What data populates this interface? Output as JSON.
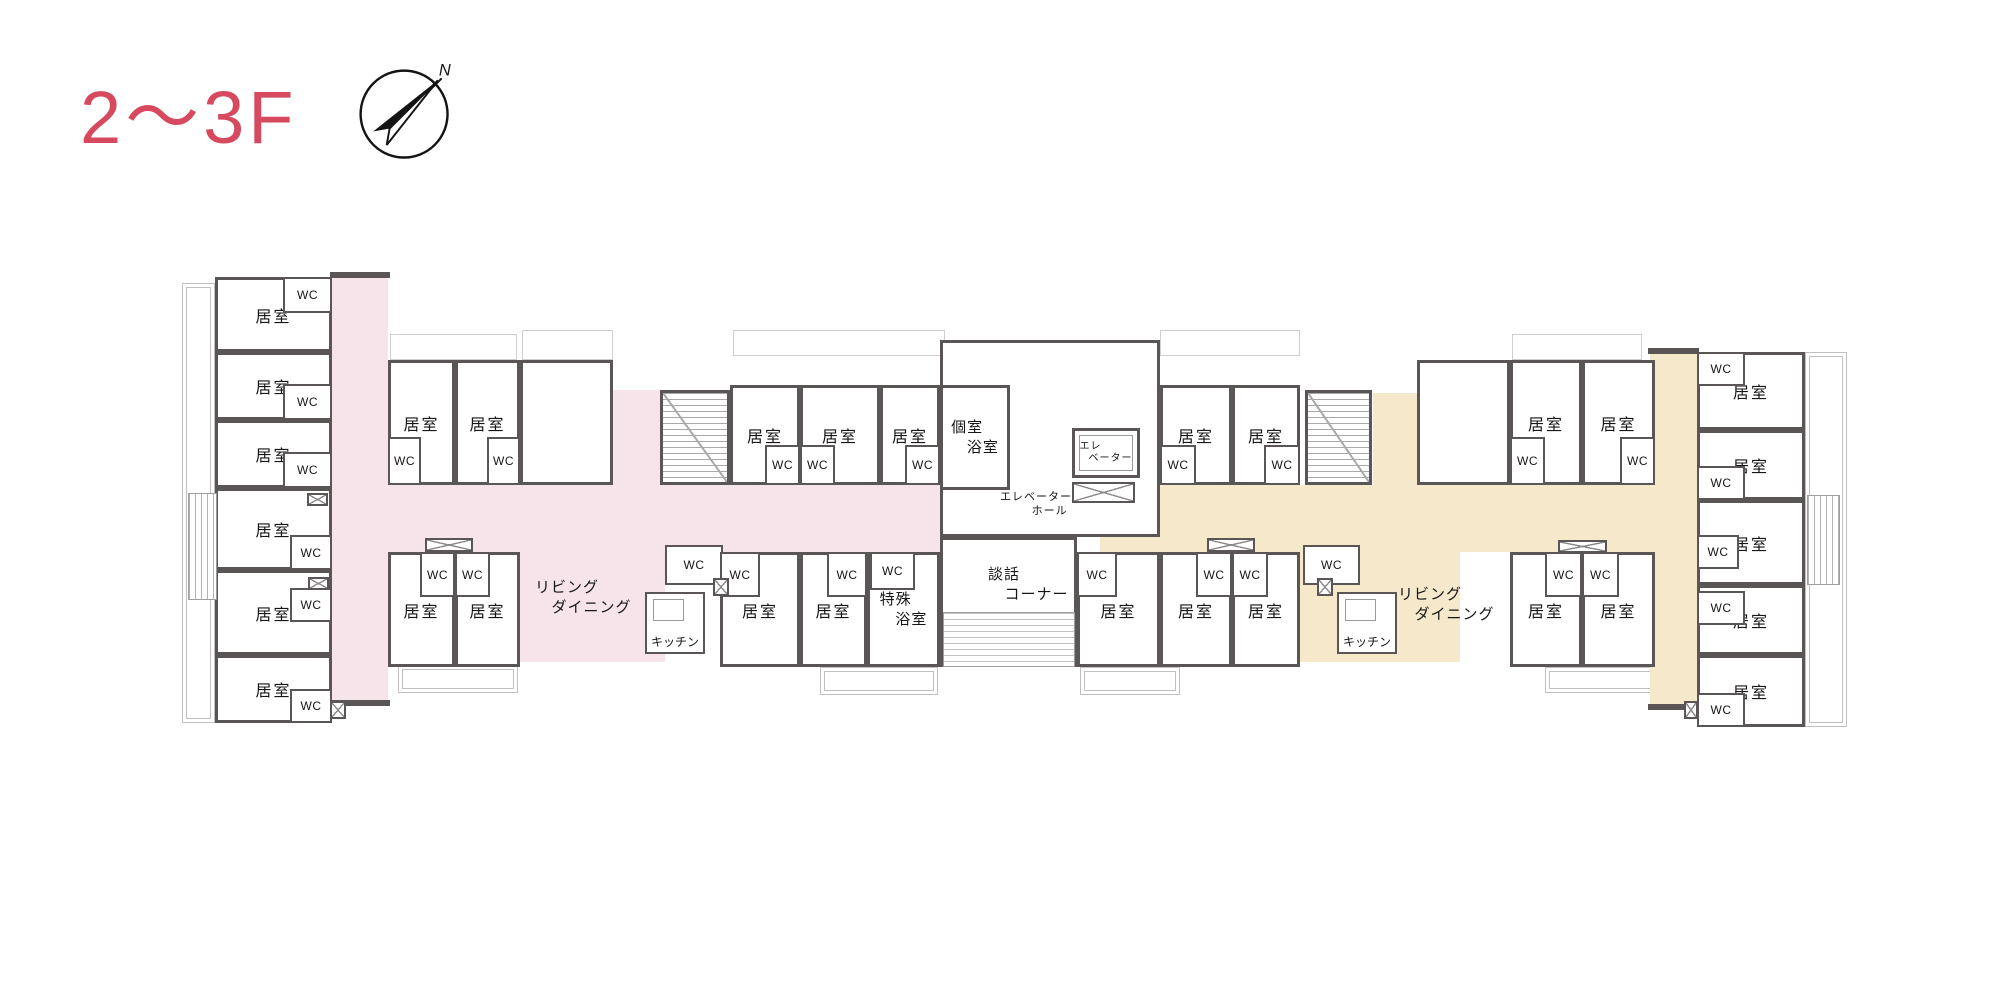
{
  "page": {
    "background": "#ffffff"
  },
  "header": {
    "title": "2〜3F",
    "compass_label": "N",
    "compass_icon": "compass-north-arrow"
  },
  "palette": {
    "accent": "#d6495f",
    "wall": "#5a5656",
    "corridor_pink": "#f7e4ea",
    "corridor_beige": "#f6e8ca",
    "hatch_line": "#a9a9a9",
    "deck_line": "#c0c0c0",
    "text": "#161616"
  },
  "floorplan": {
    "corridors": [
      {
        "x": 332,
        "y": 277,
        "w": 56,
        "h": 428,
        "color": "pink"
      },
      {
        "x": 332,
        "y": 485,
        "w": 608,
        "h": 67,
        "color": "pink"
      },
      {
        "x": 613,
        "y": 390,
        "w": 47,
        "h": 100,
        "color": "pink"
      },
      {
        "x": 520,
        "y": 537,
        "w": 145,
        "h": 125,
        "color": "pink"
      },
      {
        "x": 1650,
        "y": 353,
        "w": 47,
        "h": 357,
        "color": "beige"
      },
      {
        "x": 1100,
        "y": 485,
        "w": 550,
        "h": 67,
        "color": "beige"
      },
      {
        "x": 1373,
        "y": 393,
        "w": 44,
        "h": 92,
        "color": "beige"
      },
      {
        "x": 1300,
        "y": 537,
        "w": 160,
        "h": 125,
        "color": "beige"
      }
    ],
    "rooms": [
      {
        "x": 940,
        "y": 340,
        "w": 220,
        "h": 197,
        "label": null
      },
      {
        "x": 940,
        "y": 537,
        "w": 137,
        "h": 130,
        "label": null
      },
      {
        "x": 215,
        "y": 277,
        "w": 117,
        "h": 75,
        "label": "居室"
      },
      {
        "x": 215,
        "y": 352,
        "w": 117,
        "h": 68,
        "label": "居室"
      },
      {
        "x": 215,
        "y": 420,
        "w": 117,
        "h": 68,
        "label": "居室"
      },
      {
        "x": 215,
        "y": 488,
        "w": 117,
        "h": 82,
        "label": "居室"
      },
      {
        "x": 215,
        "y": 570,
        "w": 117,
        "h": 85,
        "label": "居室"
      },
      {
        "x": 215,
        "y": 655,
        "w": 117,
        "h": 68,
        "label": "居室"
      },
      {
        "x": 388,
        "y": 360,
        "w": 67,
        "h": 125,
        "label": "居室"
      },
      {
        "x": 455,
        "y": 360,
        "w": 65,
        "h": 125,
        "label": "居室"
      },
      {
        "x": 520,
        "y": 360,
        "w": 93,
        "h": 125,
        "label": null
      },
      {
        "x": 730,
        "y": 385,
        "w": 70,
        "h": 100,
        "label": "居室"
      },
      {
        "x": 800,
        "y": 385,
        "w": 80,
        "h": 100,
        "label": "居室"
      },
      {
        "x": 880,
        "y": 385,
        "w": 60,
        "h": 100,
        "label": "居室"
      },
      {
        "x": 940,
        "y": 385,
        "w": 70,
        "h": 105,
        "lines": [
          "個室",
          "浴室"
        ]
      },
      {
        "x": 388,
        "y": 552,
        "w": 67,
        "h": 115,
        "label": "居室"
      },
      {
        "x": 455,
        "y": 552,
        "w": 65,
        "h": 115,
        "label": "居室"
      },
      {
        "x": 720,
        "y": 552,
        "w": 80,
        "h": 115,
        "label": "居室"
      },
      {
        "x": 800,
        "y": 552,
        "w": 67,
        "h": 115,
        "label": "居室"
      },
      {
        "x": 867,
        "y": 552,
        "w": 73,
        "h": 115,
        "lines": [
          "特殊",
          "浴室"
        ]
      },
      {
        "x": 1160,
        "y": 385,
        "w": 72,
        "h": 100,
        "label": "居室"
      },
      {
        "x": 1232,
        "y": 385,
        "w": 68,
        "h": 100,
        "label": "居室"
      },
      {
        "x": 1417,
        "y": 360,
        "w": 93,
        "h": 125,
        "label": null
      },
      {
        "x": 1510,
        "y": 360,
        "w": 72,
        "h": 125,
        "label": "居室"
      },
      {
        "x": 1582,
        "y": 360,
        "w": 73,
        "h": 125,
        "label": "居室"
      },
      {
        "x": 1077,
        "y": 552,
        "w": 83,
        "h": 115,
        "label": "居室"
      },
      {
        "x": 1160,
        "y": 552,
        "w": 72,
        "h": 115,
        "label": "居室"
      },
      {
        "x": 1232,
        "y": 552,
        "w": 68,
        "h": 115,
        "label": "居室"
      },
      {
        "x": 1510,
        "y": 552,
        "w": 72,
        "h": 115,
        "label": "居室"
      },
      {
        "x": 1582,
        "y": 552,
        "w": 73,
        "h": 115,
        "label": "居室"
      },
      {
        "x": 1697,
        "y": 352,
        "w": 108,
        "h": 78,
        "label": "居室"
      },
      {
        "x": 1697,
        "y": 430,
        "w": 108,
        "h": 70,
        "label": "居室"
      },
      {
        "x": 1697,
        "y": 500,
        "w": 108,
        "h": 85,
        "label": "居室"
      },
      {
        "x": 1697,
        "y": 585,
        "w": 108,
        "h": 70,
        "label": "居室"
      },
      {
        "x": 1697,
        "y": 655,
        "w": 108,
        "h": 72,
        "label": "居室"
      }
    ],
    "closets": [
      {
        "x": 283,
        "y": 277,
        "w": 49,
        "h": 36,
        "label": "WC"
      },
      {
        "x": 283,
        "y": 384,
        "w": 49,
        "h": 36,
        "label": "WC"
      },
      {
        "x": 283,
        "y": 452,
        "w": 49,
        "h": 36,
        "label": "WC"
      },
      {
        "x": 290,
        "y": 535,
        "w": 42,
        "h": 35,
        "label": "WC"
      },
      {
        "x": 290,
        "y": 588,
        "w": 42,
        "h": 34,
        "label": "WC"
      },
      {
        "x": 290,
        "y": 689,
        "w": 42,
        "h": 34,
        "label": "WC"
      },
      {
        "x": 388,
        "y": 437,
        "w": 33,
        "h": 48,
        "label": "WC"
      },
      {
        "x": 487,
        "y": 437,
        "w": 33,
        "h": 48,
        "label": "WC"
      },
      {
        "x": 765,
        "y": 445,
        "w": 35,
        "h": 40,
        "label": "WC"
      },
      {
        "x": 800,
        "y": 445,
        "w": 35,
        "h": 40,
        "label": "WC"
      },
      {
        "x": 905,
        "y": 445,
        "w": 35,
        "h": 40,
        "label": "WC"
      },
      {
        "x": 420,
        "y": 552,
        "w": 35,
        "h": 45,
        "label": "WC"
      },
      {
        "x": 455,
        "y": 552,
        "w": 35,
        "h": 45,
        "label": "WC"
      },
      {
        "x": 665,
        "y": 545,
        "w": 58,
        "h": 40,
        "label": "WC"
      },
      {
        "x": 720,
        "y": 552,
        "w": 40,
        "h": 45,
        "label": "WC"
      },
      {
        "x": 827,
        "y": 552,
        "w": 40,
        "h": 45,
        "label": "WC"
      },
      {
        "x": 870,
        "y": 552,
        "w": 45,
        "h": 38,
        "label": "WC"
      },
      {
        "x": 1160,
        "y": 445,
        "w": 36,
        "h": 40,
        "label": "WC"
      },
      {
        "x": 1264,
        "y": 445,
        "w": 36,
        "h": 40,
        "label": "WC"
      },
      {
        "x": 1510,
        "y": 437,
        "w": 35,
        "h": 48,
        "label": "WC"
      },
      {
        "x": 1620,
        "y": 437,
        "w": 35,
        "h": 48,
        "label": "WC"
      },
      {
        "x": 1077,
        "y": 552,
        "w": 40,
        "h": 45,
        "label": "WC"
      },
      {
        "x": 1196,
        "y": 552,
        "w": 36,
        "h": 45,
        "label": "WC"
      },
      {
        "x": 1232,
        "y": 552,
        "w": 36,
        "h": 45,
        "label": "WC"
      },
      {
        "x": 1303,
        "y": 545,
        "w": 57,
        "h": 40,
        "label": "WC"
      },
      {
        "x": 1545,
        "y": 552,
        "w": 37,
        "h": 45,
        "label": "WC"
      },
      {
        "x": 1582,
        "y": 552,
        "w": 37,
        "h": 45,
        "label": "WC"
      },
      {
        "x": 1697,
        "y": 352,
        "w": 48,
        "h": 34,
        "label": "WC"
      },
      {
        "x": 1697,
        "y": 466,
        "w": 48,
        "h": 34,
        "label": "WC"
      },
      {
        "x": 1697,
        "y": 535,
        "w": 42,
        "h": 34,
        "label": "WC"
      },
      {
        "x": 1697,
        "y": 591,
        "w": 48,
        "h": 34,
        "label": "WC"
      },
      {
        "x": 1697,
        "y": 693,
        "w": 48,
        "h": 34,
        "label": "WC"
      }
    ],
    "kitchens": [
      {
        "x": 645,
        "y": 592,
        "w": 60,
        "h": 62,
        "label": "キッチン"
      },
      {
        "x": 1337,
        "y": 592,
        "w": 60,
        "h": 62,
        "label": "キッチン"
      }
    ],
    "elevator": {
      "x": 1072,
      "y": 428,
      "w": 68,
      "h": 50,
      "lines": [
        "エレ",
        "ベーター"
      ]
    },
    "stairs": [
      {
        "x": 660,
        "y": 390,
        "w": 70,
        "h": 95
      },
      {
        "x": 1305,
        "y": 390,
        "w": 67,
        "h": 95
      }
    ],
    "hatches": [
      {
        "x": 188,
        "y": 493,
        "w": 29,
        "h": 107,
        "dir": "v"
      },
      {
        "x": 1807,
        "y": 495,
        "w": 33,
        "h": 90,
        "dir": "v"
      },
      {
        "x": 943,
        "y": 612,
        "w": 132,
        "h": 55,
        "dir": "h"
      }
    ],
    "decks": [
      {
        "x": 182,
        "y": 283,
        "w": 33,
        "h": 440
      },
      {
        "x": 1805,
        "y": 352,
        "w": 42,
        "h": 375
      },
      {
        "x": 398,
        "y": 665,
        "w": 120,
        "h": 28
      },
      {
        "x": 820,
        "y": 667,
        "w": 118,
        "h": 28
      },
      {
        "x": 1080,
        "y": 667,
        "w": 100,
        "h": 28
      },
      {
        "x": 1545,
        "y": 667,
        "w": 110,
        "h": 26
      }
    ],
    "notches": [
      {
        "x": 390,
        "y": 334,
        "w": 127,
        "h": 26
      },
      {
        "x": 522,
        "y": 330,
        "w": 91,
        "h": 30
      },
      {
        "x": 733,
        "y": 330,
        "w": 212,
        "h": 26
      },
      {
        "x": 1160,
        "y": 330,
        "w": 140,
        "h": 26
      },
      {
        "x": 1512,
        "y": 334,
        "w": 130,
        "h": 26
      }
    ],
    "vents": [
      {
        "x": 425,
        "y": 538,
        "w": 48,
        "h": 14
      },
      {
        "x": 1207,
        "y": 538,
        "w": 48,
        "h": 14
      },
      {
        "x": 1558,
        "y": 540,
        "w": 49,
        "h": 13
      },
      {
        "x": 1072,
        "y": 482,
        "w": 63,
        "h": 21
      },
      {
        "x": 713,
        "y": 578,
        "w": 16,
        "h": 18
      },
      {
        "x": 1317,
        "y": 578,
        "w": 16,
        "h": 18
      },
      {
        "x": 330,
        "y": 701,
        "w": 16,
        "h": 18
      },
      {
        "x": 1684,
        "y": 701,
        "w": 14,
        "h": 18
      },
      {
        "x": 307,
        "y": 493,
        "w": 21,
        "h": 13
      },
      {
        "x": 308,
        "y": 577,
        "w": 21,
        "h": 13
      }
    ],
    "walls": [
      {
        "x": 330,
        "y": 272,
        "w": 60,
        "h": 6
      },
      {
        "x": 330,
        "y": 700,
        "w": 60,
        "h": 6
      },
      {
        "x": 1648,
        "y": 348,
        "w": 51,
        "h": 6
      },
      {
        "x": 1648,
        "y": 704,
        "w": 51,
        "h": 6
      }
    ],
    "labels": [
      {
        "x": 535,
        "y": 578,
        "lines": [
          "リビング",
          "ダイニング"
        ],
        "size": 15
      },
      {
        "x": 1398,
        "y": 585,
        "lines": [
          "リビング",
          "ダイニング"
        ],
        "size": 15
      },
      {
        "x": 972,
        "y": 490,
        "w": 100,
        "lines": [
          "エレベーター",
          "ホール"
        ],
        "size": 11,
        "align": "right"
      },
      {
        "x": 988,
        "y": 565,
        "lines": [
          "談話",
          "コーナー"
        ],
        "size": 15
      }
    ]
  }
}
